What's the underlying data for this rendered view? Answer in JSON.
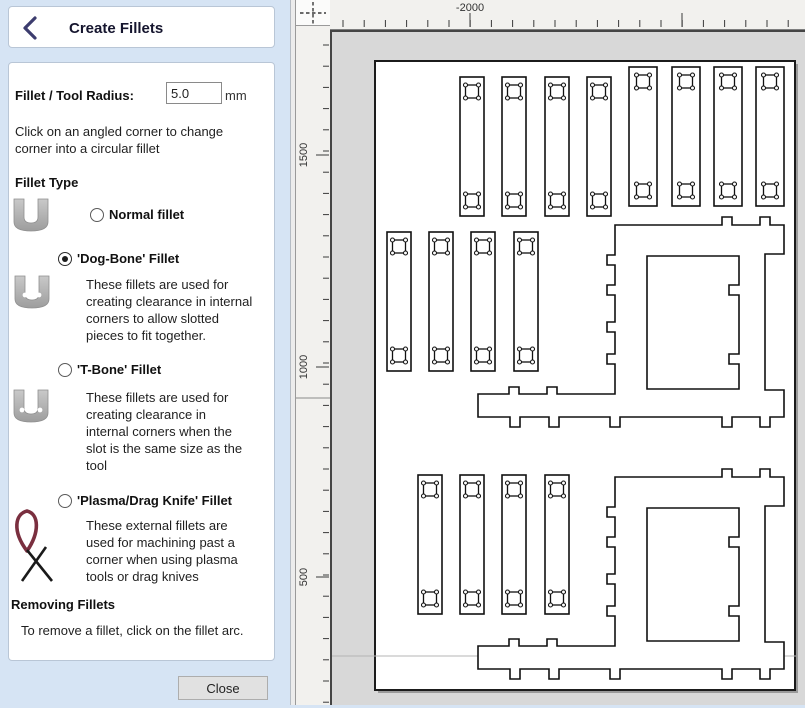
{
  "panel": {
    "title": "Create Fillets",
    "radius_label": "Fillet / Tool Radius:",
    "radius_value": "5.0",
    "radius_unit": "mm",
    "intro": "Click on an angled corner to change\ncorner into a circular fillet",
    "fillet_type_heading": "Fillet Type",
    "options": [
      {
        "label": "Normal fillet",
        "selected": false,
        "icon": "u-slot-icon",
        "description": ""
      },
      {
        "label": "'Dog-Bone' Fillet",
        "selected": true,
        "icon": "u-slot-dogbone-icon",
        "description": "These fillets are used for\ncreating clearance in internal\ncorners to allow slotted\npieces to fit together."
      },
      {
        "label": "'T-Bone' Fillet",
        "selected": false,
        "icon": "u-slot-tbone-icon",
        "description": "These fillets are used for\ncreating clearance in\ninternal corners when the\nslot is the same size as the\ntool"
      },
      {
        "label": "'Plasma/Drag Knife' Fillet",
        "selected": false,
        "icon": "plasma-knife-icon",
        "description": "These external fillets are\nused for machining past a\ncorner when using plasma\ntools or drag knives"
      }
    ],
    "removing_heading": "Removing Fillets",
    "removing_text": "To remove a fillet, click on the fillet arc.",
    "close_label": "Close"
  },
  "rulers": {
    "horizontal": {
      "minor_start": 13,
      "minor_step": 21.2,
      "minor_count": 22,
      "majors": [
        {
          "x": 140,
          "label": "-2000"
        },
        {
          "x": 352,
          "label": ""
        }
      ]
    },
    "vertical": {
      "minor_start": 19,
      "minor_step": 21.2,
      "minor_count": 32,
      "majors": [
        {
          "y": 129,
          "label": "1500"
        },
        {
          "y": 341,
          "label": "1000"
        },
        {
          "y": 551,
          "label": "500"
        }
      ],
      "break_y": 372
    }
  },
  "colors": {
    "panel_background": "#d6e4f4",
    "card_background": "#ffffff",
    "title_text": "#15152e",
    "back_chevron": "#3c3c6e",
    "canvas_background": "#d8d8d8",
    "sheet": "#ffffff",
    "outline_stroke": "#111111",
    "plasma_loop": "#7a2f3f"
  }
}
